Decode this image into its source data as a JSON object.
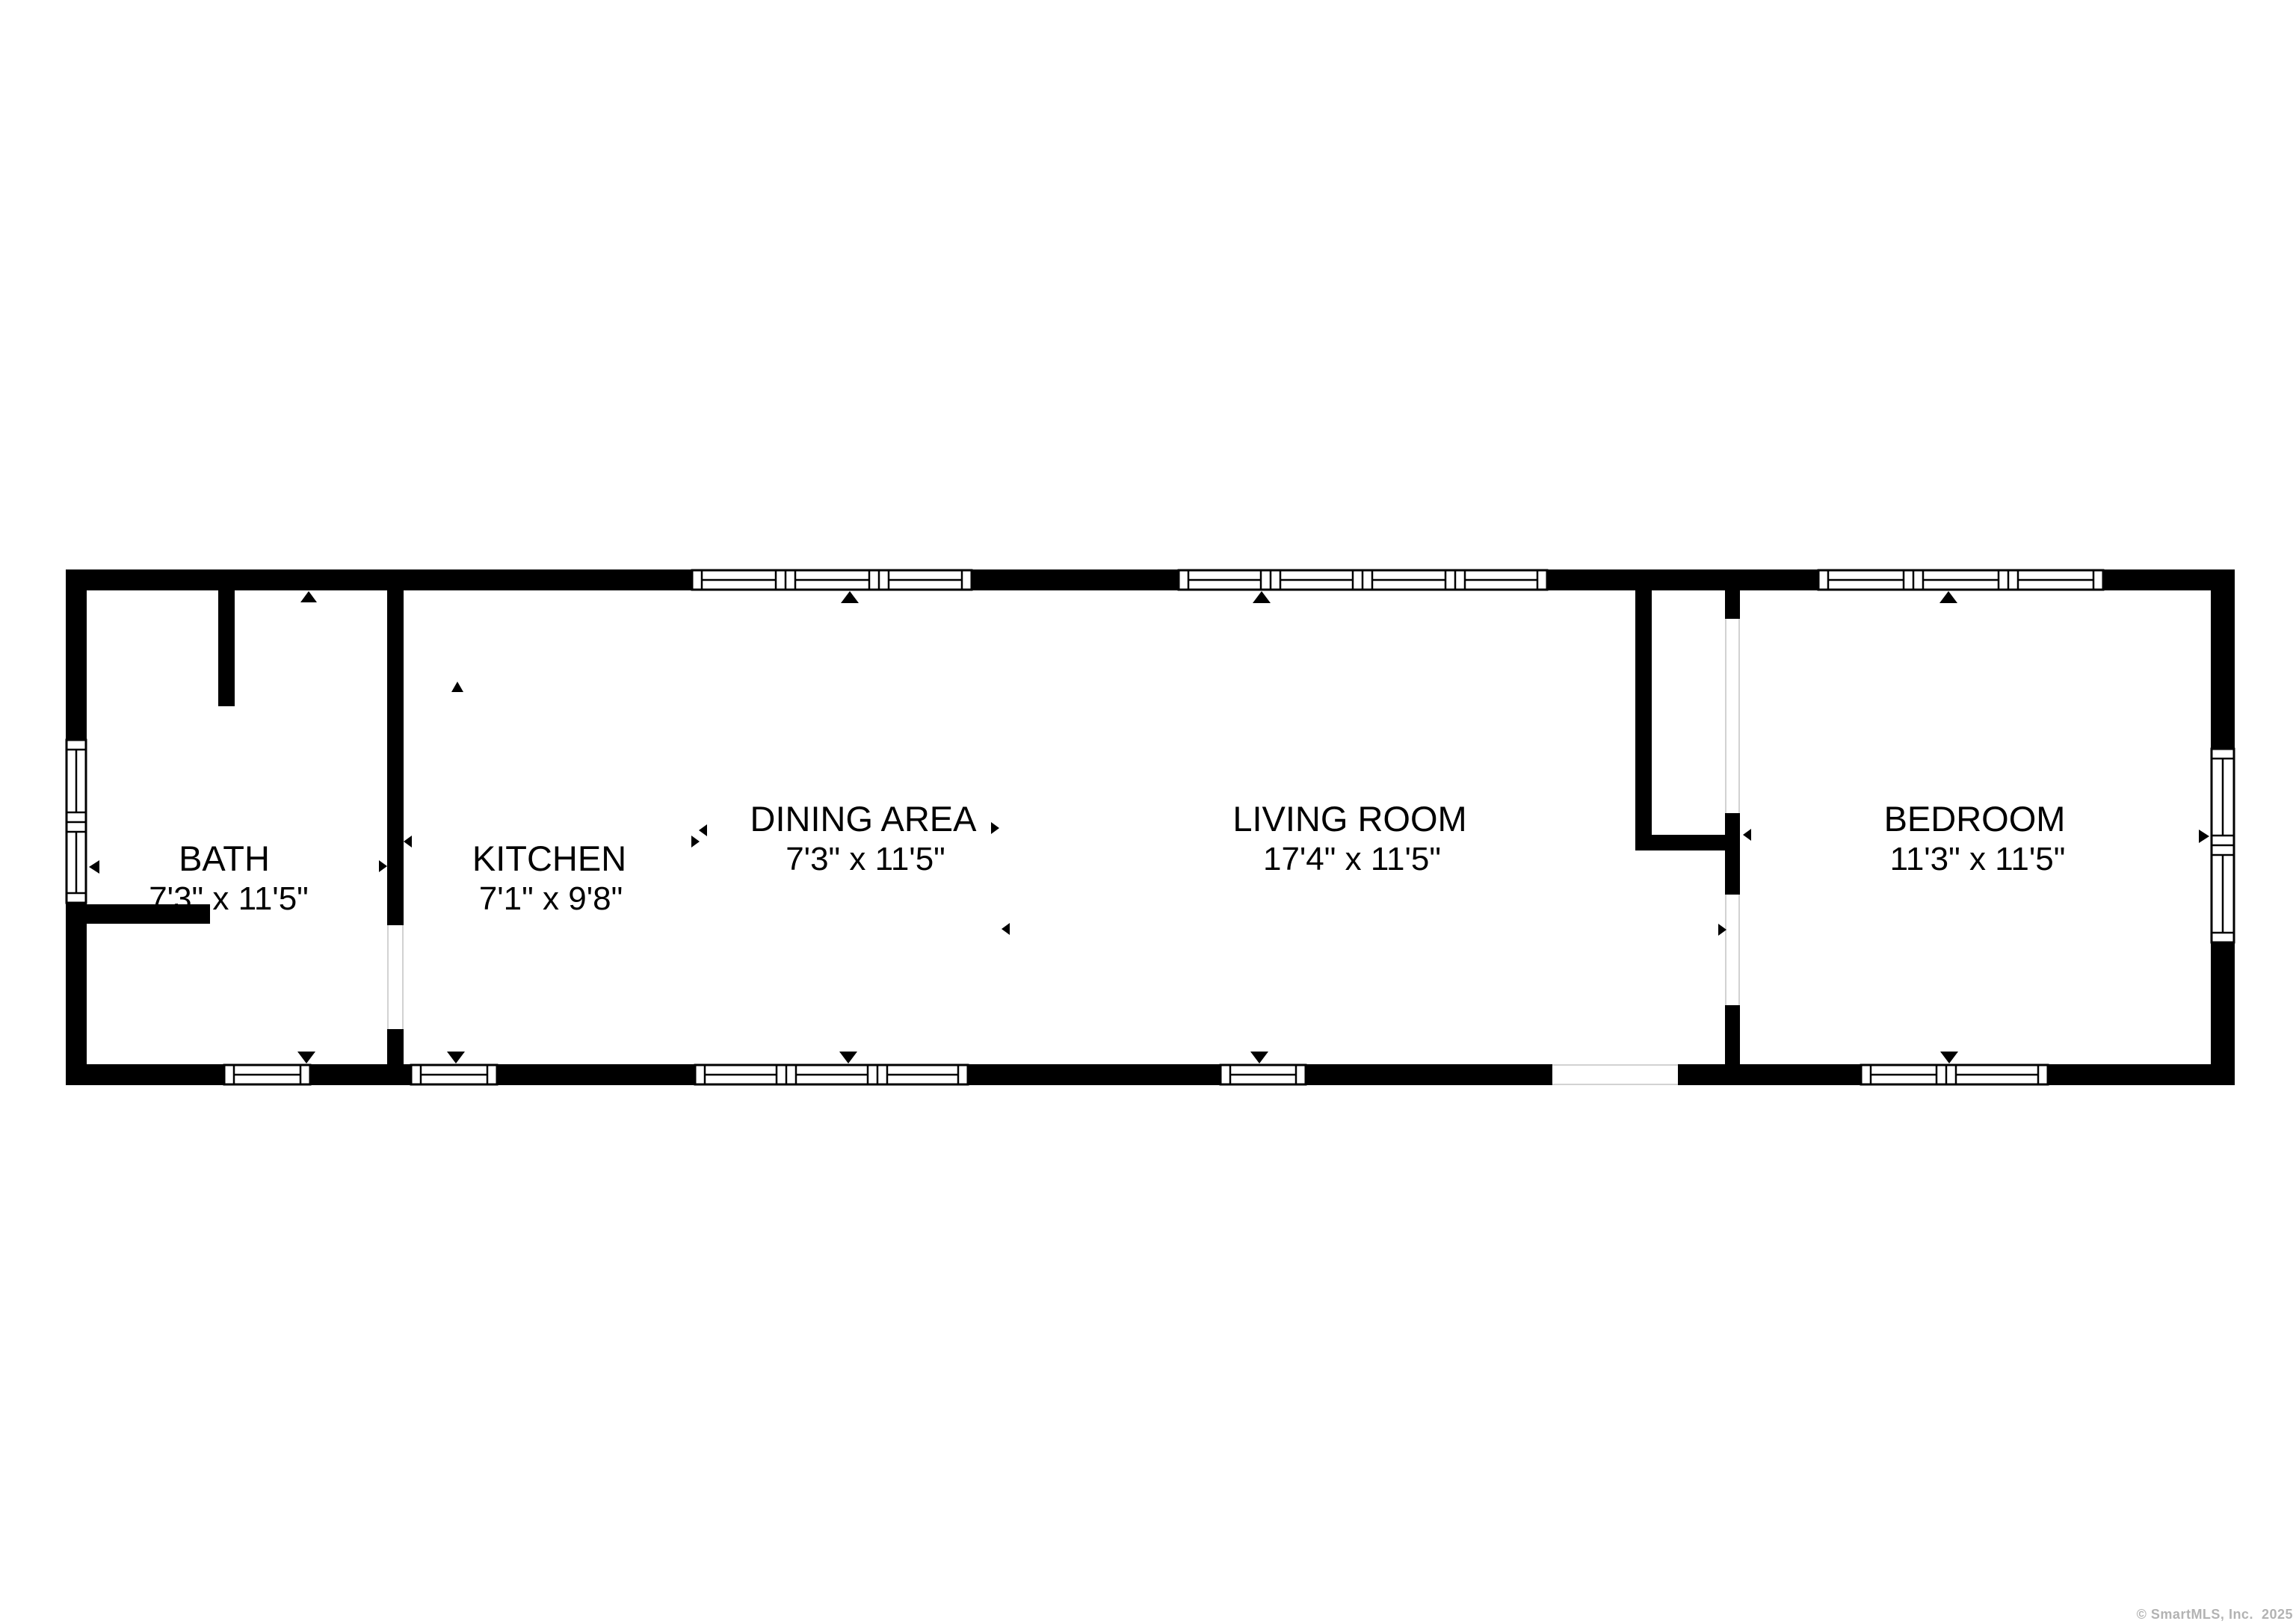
{
  "watermark": "© SmartMLS, Inc.  2025",
  "rooms": [
    {
      "id": "bath",
      "name": "BATH",
      "dims": "7'3\" x 11'5\""
    },
    {
      "id": "kitchen",
      "name": "KITCHEN",
      "dims": "7'1\" x 9'8\""
    },
    {
      "id": "dining",
      "name": "DINING AREA",
      "dims": "7'3\" x 11'5\""
    },
    {
      "id": "living",
      "name": "LIVING ROOM",
      "dims": "17'4\" x 11'5\""
    },
    {
      "id": "bedroom",
      "name": "BEDROOM",
      "dims": "11'3\" x 11'5\""
    }
  ],
  "colors": {
    "wall": "#000000",
    "background": "#ffffff",
    "jamb_line": "#d2d2d2",
    "watermark_gray": "#b3b3b3"
  }
}
